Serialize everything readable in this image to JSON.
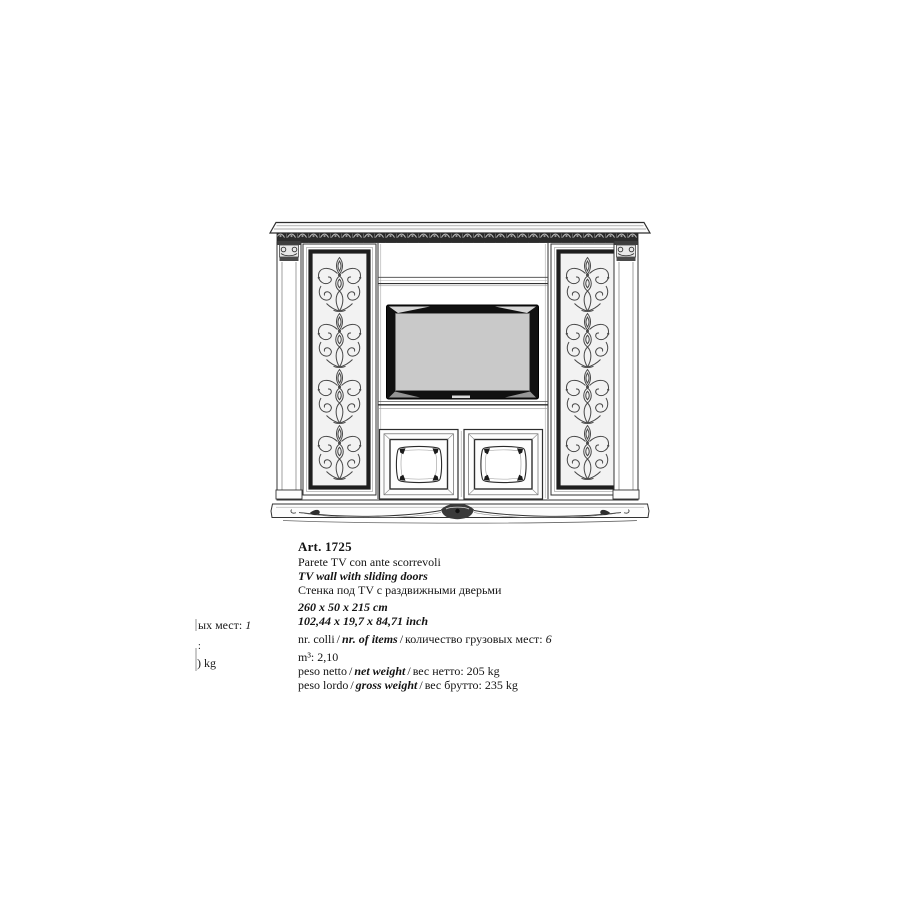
{
  "page": {
    "background": "#ffffff"
  },
  "spec": {
    "art_code": "Art. 1725",
    "name_it": "Parete TV con ante scorrevoli",
    "name_en": "TV wall with sliding doors",
    "name_ru": "Стенка под TV с  раздвижными дверьми",
    "dimensions_cm": "260 x 50 x 215 cm",
    "dimensions_inch": "102,44 x 19,7 x 84,71 inch",
    "sep": "/",
    "packages": {
      "label_it": "nr. colli",
      "label_en": "nr. of items",
      "label_ru": "количество грузовых мест:",
      "value": "6"
    },
    "volume": {
      "label": "m³:",
      "value": "2,10"
    },
    "net_weight": {
      "label_it": "peso netto",
      "label_en": "net weight",
      "label_ru": "вес нетто:",
      "value": "205 kg"
    },
    "gross_weight": {
      "label_it": "peso lordo",
      "label_en": "gross weight",
      "label_ru": "вес брутто:",
      "value": "235 kg"
    }
  },
  "cutoff": {
    "places_label": "ых мест:",
    "places_value": "1",
    "colon": ":",
    "kg": ") kg"
  },
  "drawing": {
    "description": "Technical line drawing of a classical TV wall unit: carved cornice frieze, two ornate fretwork sliding door panels with pilasters, central open shelf, TV niche and two lower panelled cabinet doors on a carved plinth",
    "line_color": "#2e2e2e",
    "tv_screen_color": "#c9c9c9"
  }
}
